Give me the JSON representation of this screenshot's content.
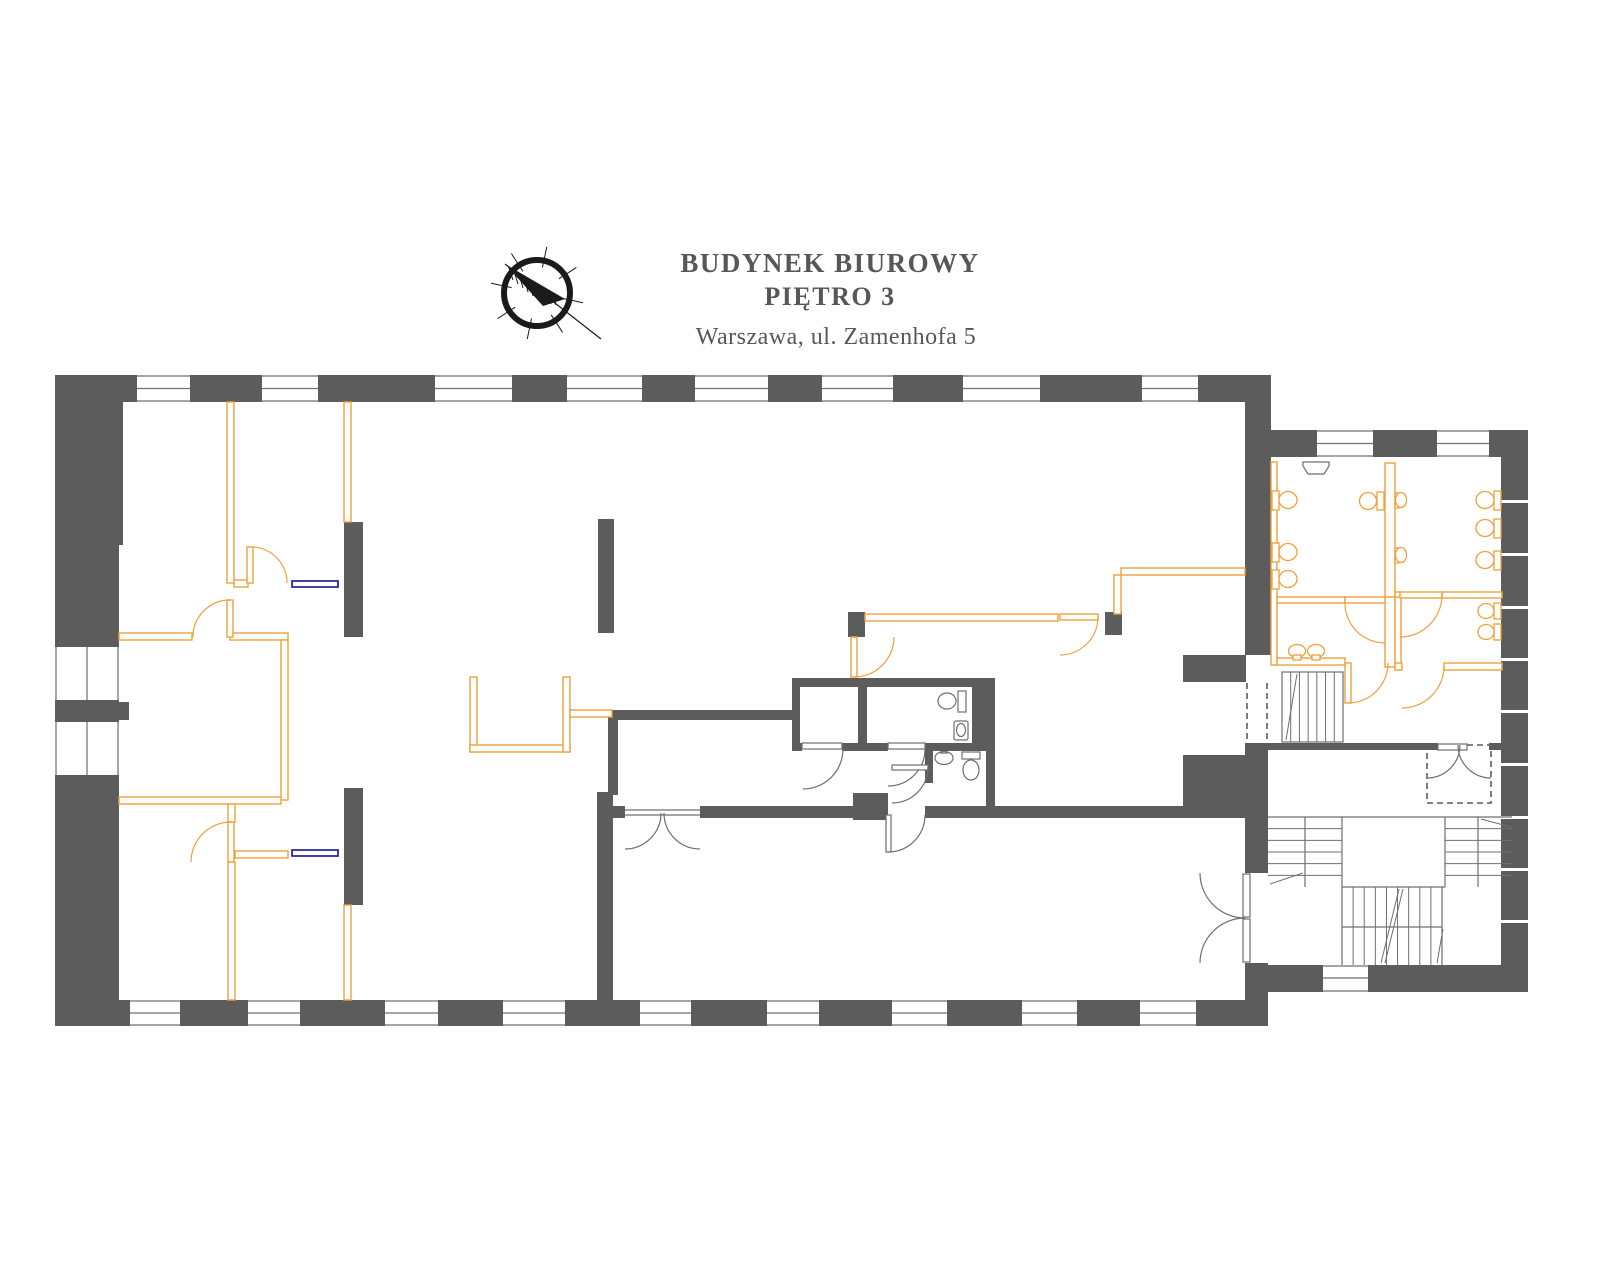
{
  "header": {
    "building": "BUDYNEK BIUROWY",
    "floor": "PIĘTRO 3",
    "address": "Warszawa, ul. Zamenhofa 5"
  },
  "icons": {
    "compass": "compass-rose-icon"
  },
  "colors": {
    "wall": "#5C5C5C",
    "partition_orange": "#EFA13B",
    "window_marker_blue": "#20209A",
    "thin_line": "#6F6F6F",
    "text": "#575757",
    "background": "#FFFFFF"
  }
}
